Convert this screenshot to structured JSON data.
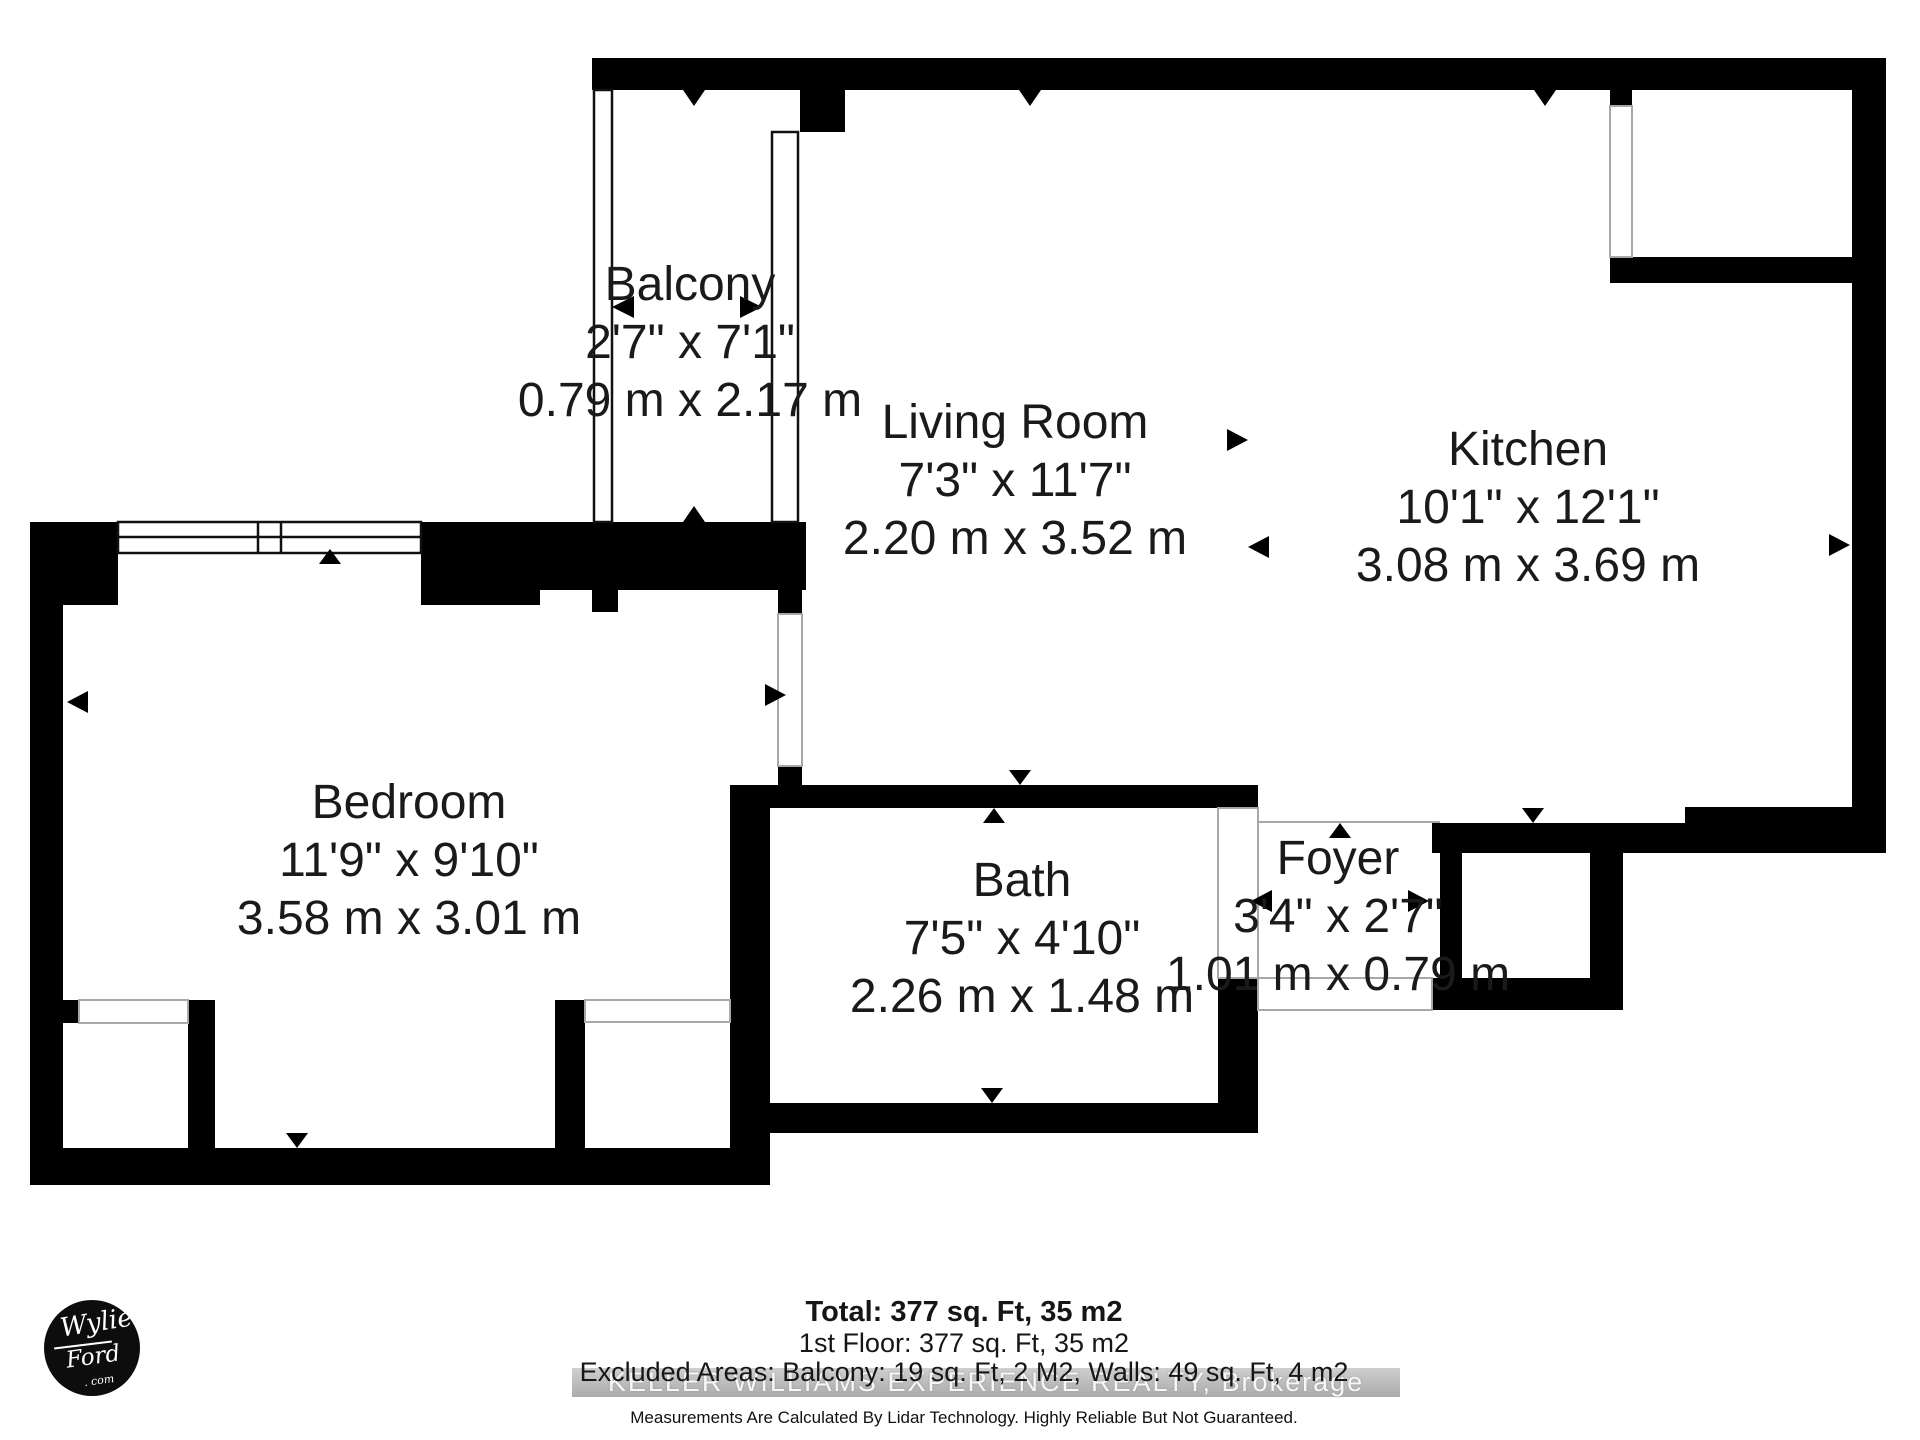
{
  "rooms": [
    {
      "name": "Balcony",
      "imperial": "2'7\" x 7'1\"",
      "metric": "0.79 m x 2.17 m"
    },
    {
      "name": "Living Room",
      "imperial": "7'3\" x 11'7\"",
      "metric": "2.20 m x 3.52 m"
    },
    {
      "name": "Kitchen",
      "imperial": "10'1\" x 12'1\"",
      "metric": "3.08 m x 3.69 m"
    },
    {
      "name": "Bedroom",
      "imperial": "11'9\" x 9'10\"",
      "metric": "3.58 m x 3.01 m"
    },
    {
      "name": "Bath",
      "imperial": "7'5\" x 4'10\"",
      "metric": "2.26 m x 1.48 m"
    },
    {
      "name": "Foyer",
      "imperial": "3'4\" x 2'7\"",
      "metric": "1.01 m x 0.79 m"
    }
  ],
  "footer": {
    "total": "Total: 377 sq. Ft, 35 m2",
    "first_floor": "1st Floor: 377 sq. Ft, 35 m2",
    "excluded": "Excluded Areas: Balcony: 19 sq. Ft, 2 M2, Walls: 49 sq. Ft, 4 m2",
    "brokerage": "KELLER WILLIAMS EXPERIENCE REALTY, Brokerage",
    "disclaimer": "Measurements Are Calculated By Lidar Technology. Highly Reliable But Not Guaranteed."
  },
  "logo": {
    "line1": "Wylie",
    "line2": "Ford",
    "line3": ". com"
  },
  "colors": {
    "wall": "#000000",
    "background": "#ffffff",
    "label_text": "#1a1a1a",
    "watermark_band": "#b5b5b5",
    "watermark_text": "#f7f7f7"
  }
}
